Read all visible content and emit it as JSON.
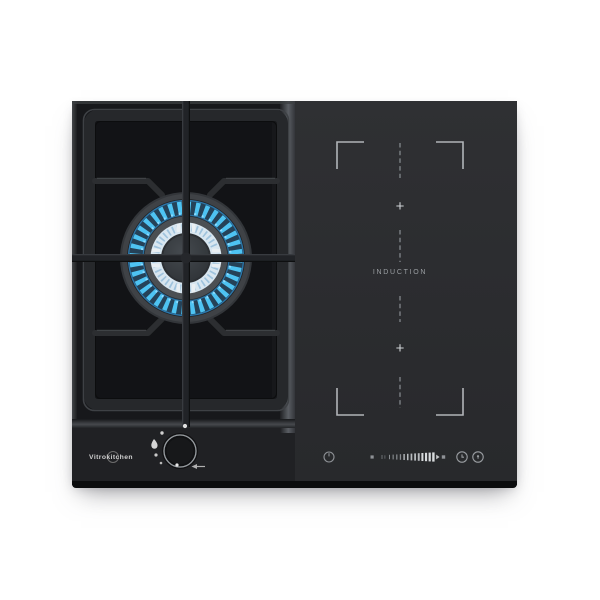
{
  "product": {
    "brand": "Vitrokitchen",
    "description": "combined gas and induction hob, black glass"
  },
  "gas_zone": {
    "burner_state": "lit",
    "flame_color": "#4ec3f2",
    "inner_flame_color": "#d8e6f0",
    "knob_icons": [
      "off-dot",
      "large-flame-droplet",
      "small-flame-dot",
      "min-flame-dot",
      "spark-arrow-left"
    ]
  },
  "induction_zone": {
    "label": "INDUCTION",
    "plus_top": "+",
    "plus_bottom": "+",
    "marking_color": "#b8bcc0"
  },
  "touch_controls": {
    "icons": [
      "power-icon",
      "zone-indicator-square",
      "power-level-slider",
      "zone-indicator-square",
      "timer-icon",
      "lock-icon"
    ]
  },
  "surface_colors": {
    "gas_glass": "#17181b",
    "induction_glass": "#2c2d30",
    "grate": "#26282b"
  }
}
